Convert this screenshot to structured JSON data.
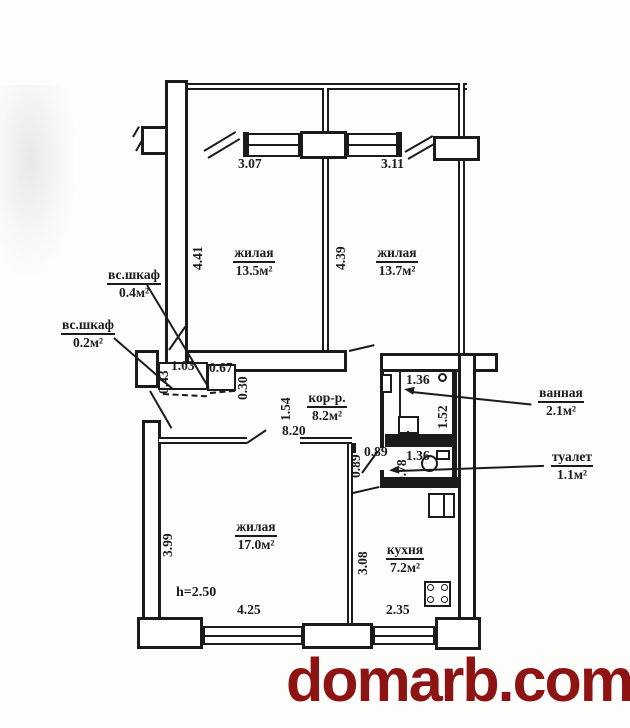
{
  "colors": {
    "ink": "#1b1b1b",
    "watermark": "#8e1414",
    "background": "#fdfdfc"
  },
  "watermark": {
    "text": "domarb.com"
  },
  "rooms": {
    "living1": {
      "name": "жилая",
      "area": "13.5м²"
    },
    "living2": {
      "name": "жилая",
      "area": "13.7м²"
    },
    "living3": {
      "name": "жилая",
      "area": "17.0м²"
    },
    "kitchen": {
      "name": "кухня",
      "area": "7.2м²"
    },
    "corridor": {
      "name": "кор-р.",
      "area": "8.2м²"
    },
    "bath": {
      "name": "ванная",
      "area": "2.1м²"
    },
    "wc": {
      "name": "туалет",
      "area": "1.1м²"
    },
    "closet_04": {
      "name": "вс.шкаф",
      "area": "0.4м²"
    },
    "closet_02": {
      "name": "вс.шкаф",
      "area": "0.2м²"
    }
  },
  "dims": {
    "living1_width": "3.07",
    "living2_width": "3.11",
    "living1_height": "4.41",
    "living2_height": "4.39",
    "closet1_depth": "0.43",
    "closet1_width": "1.03",
    "closet2_width": "0.67",
    "closet2_depth": "0.30",
    "corridor_width": "1.54",
    "corridor_length": "8.20",
    "niche_width": "0.89",
    "niche_depth": "0.89",
    "wc_depth": "0.78",
    "wc_width": "1.36",
    "bath_width": "1.36",
    "bath_depth": "1.52",
    "living3_height": "3.99",
    "living3_width": "4.25",
    "kitchen_height": "3.08",
    "kitchen_width": "2.35",
    "ceiling_height": "h=2.50"
  }
}
